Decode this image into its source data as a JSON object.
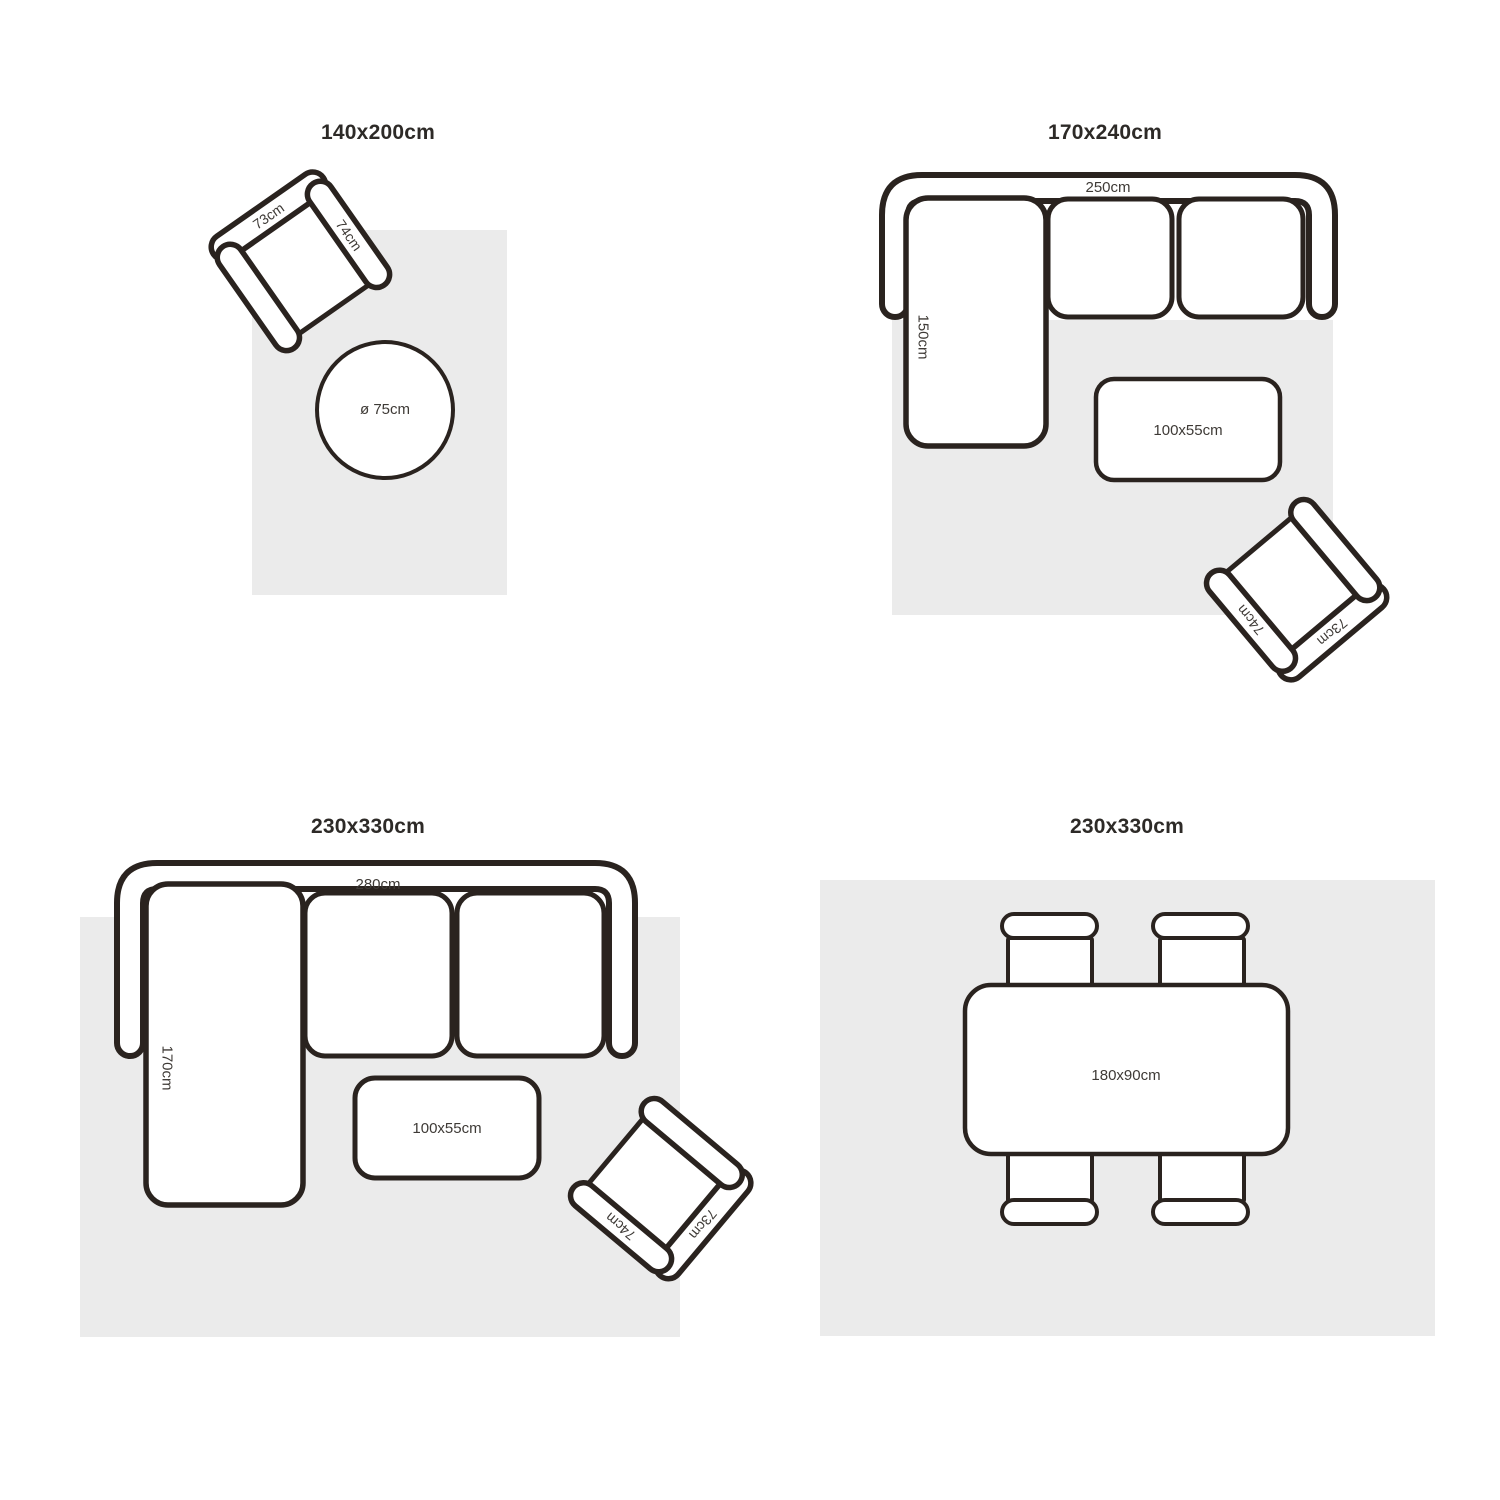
{
  "page": {
    "background": "#ffffff"
  },
  "colors": {
    "rug_fill": "#EBEBEB",
    "outline": "#2A231F",
    "label_text": "#3E3A36",
    "title_text": "#2D2A27"
  },
  "panels": {
    "p1": {
      "title": "140x200cm",
      "chair": {
        "back": "73cm",
        "arm": "74cm"
      },
      "round_table": {
        "label": "ø 75cm"
      }
    },
    "p2": {
      "title": "170x240cm",
      "sofa": {
        "width_label": "250cm",
        "depth_label": "150cm"
      },
      "coffee_table": {
        "label": "100x55cm"
      },
      "chair": {
        "back": "73cm",
        "arm": "74cm"
      }
    },
    "p3": {
      "title": "230x330cm",
      "sofa": {
        "width_label": "280cm",
        "depth_label": "170cm"
      },
      "coffee_table": {
        "label": "100x55cm"
      },
      "chair": {
        "back": "73cm",
        "arm": "74cm"
      }
    },
    "p4": {
      "title": "230x330cm",
      "dining_table": {
        "label": "180x90cm"
      }
    }
  }
}
